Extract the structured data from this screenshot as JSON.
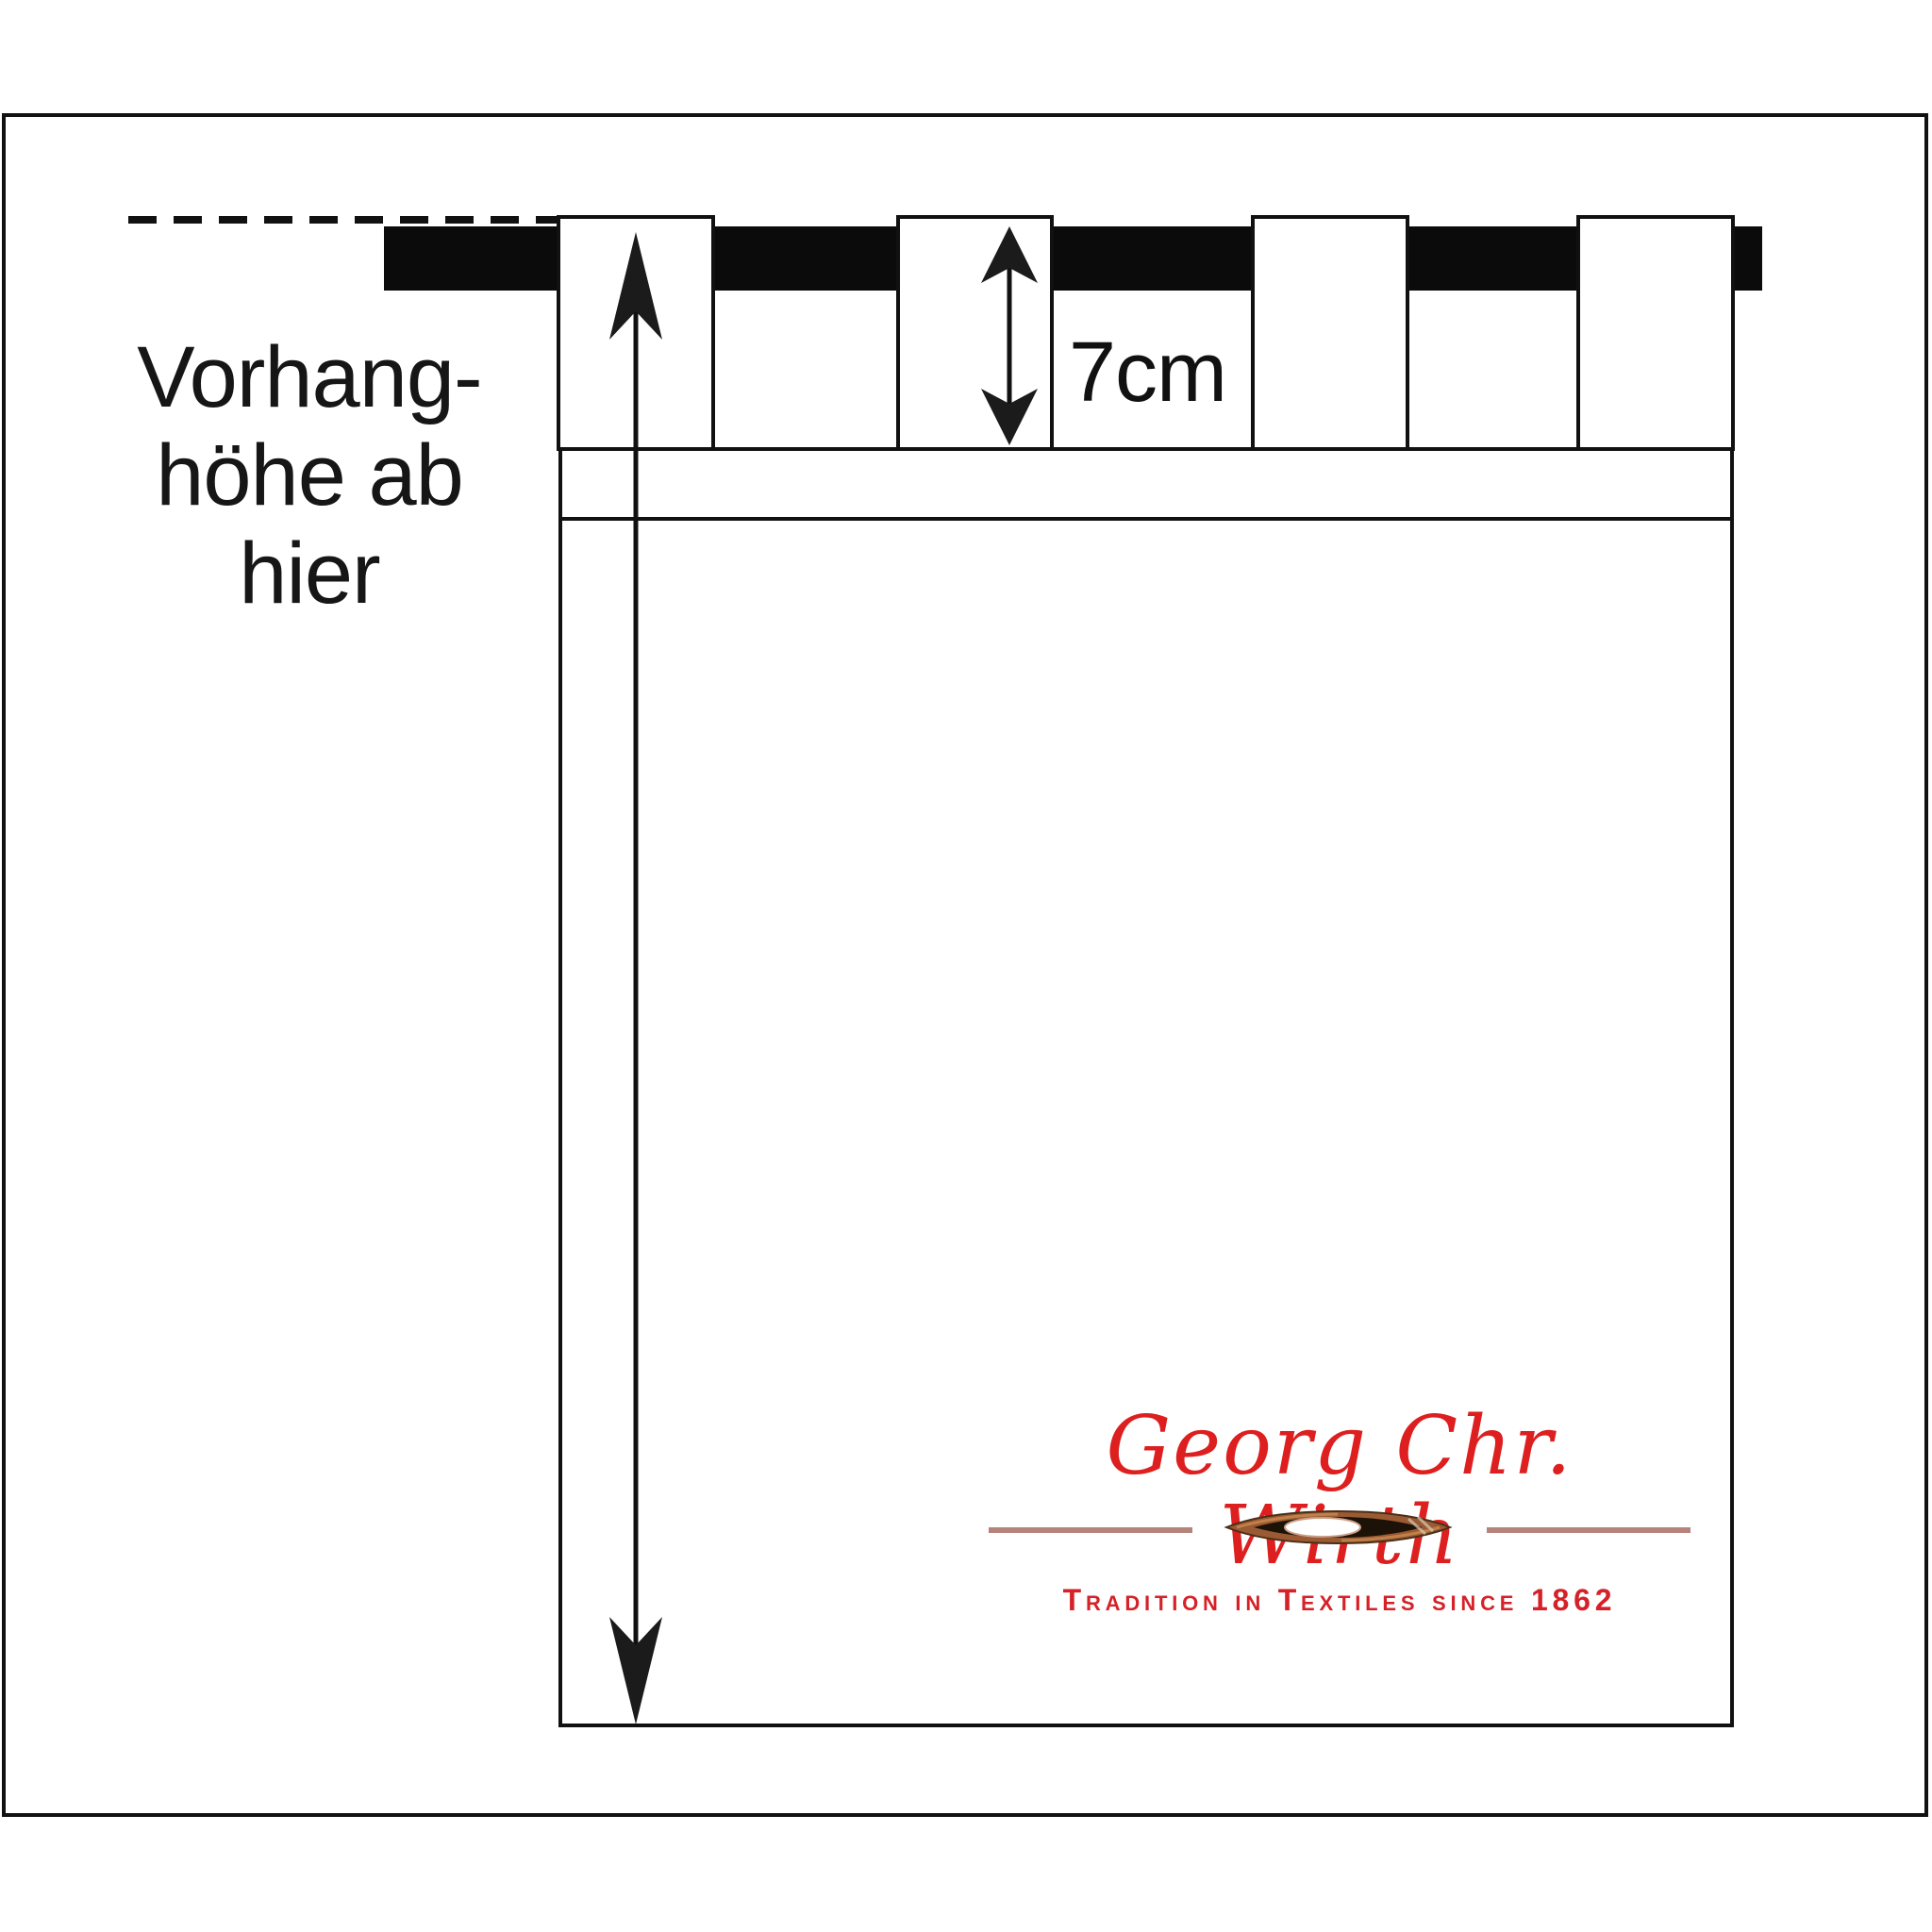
{
  "page": {
    "background": "#ffffff",
    "frame_color": "#111111"
  },
  "diagram": {
    "curtain_height_note": {
      "lines": [
        "Vorhang-",
        "höhe ab",
        "hier"
      ]
    },
    "tab_height_value": "7cm",
    "tab_count": 4,
    "elements": {
      "rod": "curtain-rod",
      "hang_reference": "dashed-hang-line",
      "height_measure": "curtain-height-arrow",
      "tab_measure": "tab-height-arrow"
    },
    "line_color": "#111111"
  },
  "logo": {
    "name": "Georg Chr. Wirth",
    "tagline": "Tradition in Textiles since 1862",
    "name_color": "#dd1f1f",
    "tagline_color": "#d62128",
    "divider_color": "#b5837a",
    "icon": "weaving-shuttle-icon"
  }
}
